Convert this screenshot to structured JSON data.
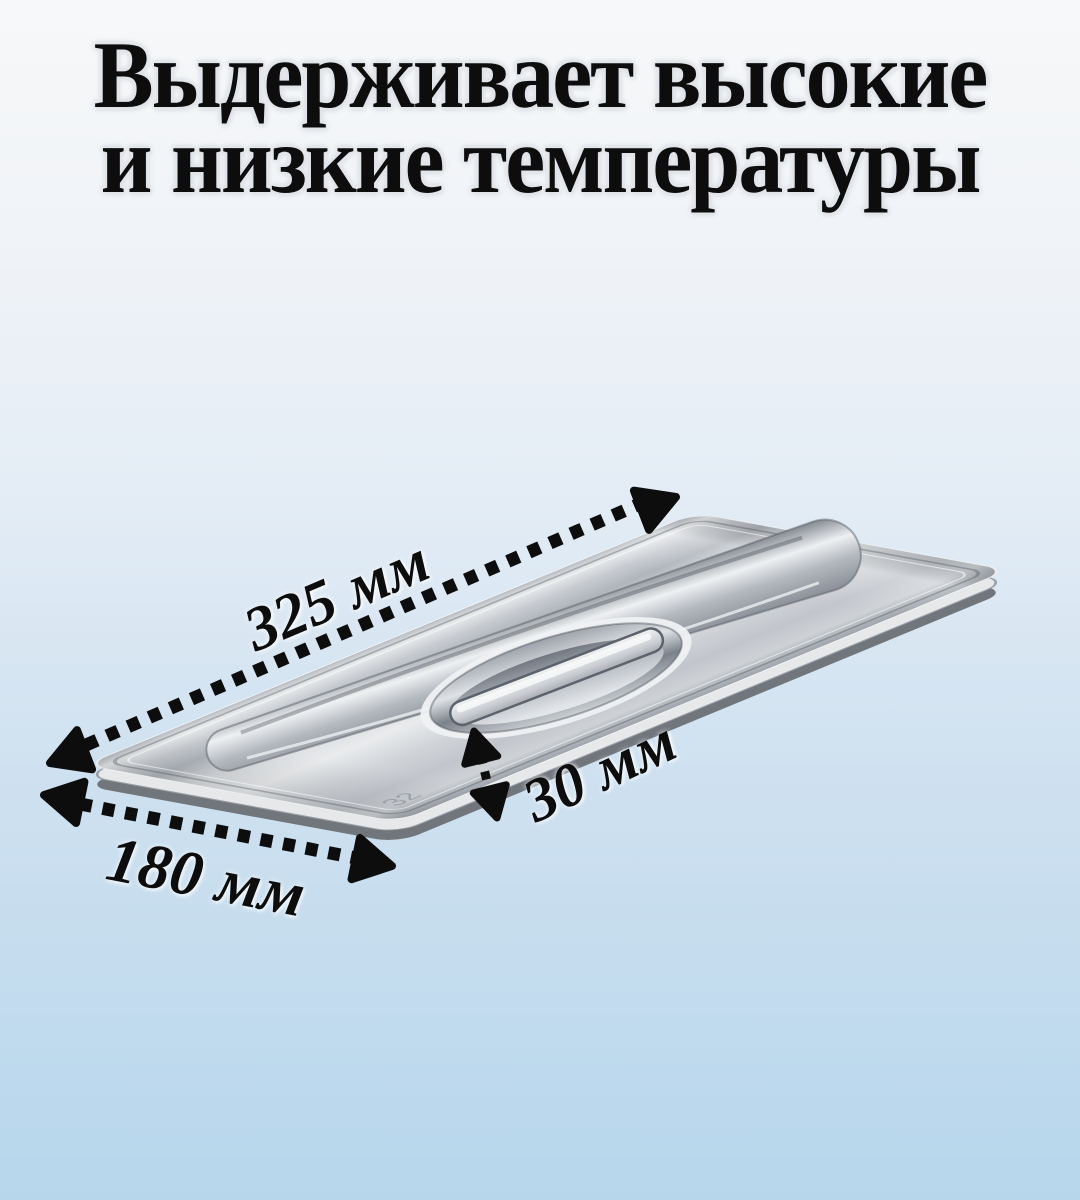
{
  "headline": {
    "line1": "Выдерживает высокие",
    "line2": "и низкие температуры"
  },
  "dimensions": {
    "length": {
      "label": "325 мм"
    },
    "width": {
      "label": "180 мм"
    },
    "height": {
      "label": "30 мм"
    }
  },
  "product": {
    "embossed_mark": "32"
  },
  "colors": {
    "ink": "#0d0d0e",
    "halo": "#e0e4e8",
    "bg-top": "#f7f8f9",
    "bg-upper": "#eef2f7",
    "bg-lower": "#cfe1f0",
    "bg-bottom": "#b7d6ec"
  }
}
